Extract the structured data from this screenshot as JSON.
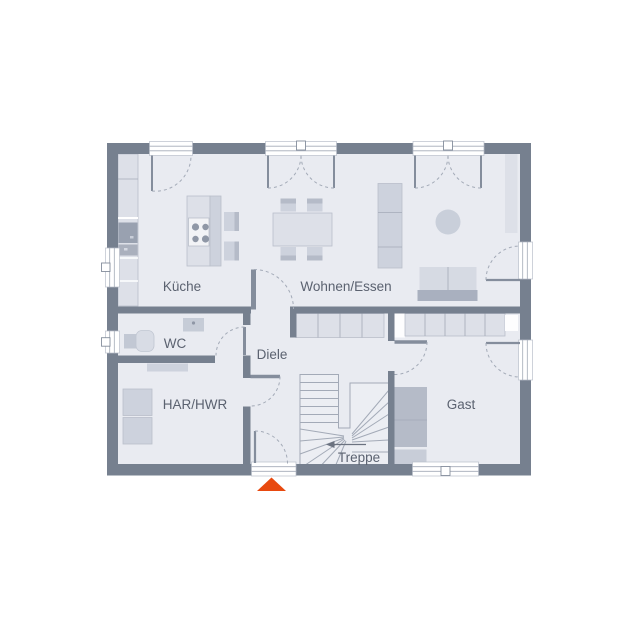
{
  "plan": {
    "rooms": {
      "kueche": "Küche",
      "wohnen_essen": "Wohnen/Essen",
      "wc": "WC",
      "diele": "Diele",
      "har_hwr": "HAR/HWR",
      "gast": "Gast",
      "treppe": "Treppe"
    }
  },
  "colors": {
    "wall": "#76808f",
    "floor": "#e9ebf1",
    "furn_light": "#dde0e8",
    "furn_mid": "#cdd2dd",
    "furn_dark": "#b5bbc8",
    "furn_edge": "#b9bfca",
    "appliance": "#99a1b0",
    "stroke": "#a3aab7",
    "leaf": "#848d9c",
    "label": "#5b6270",
    "burner": "#8f97a6",
    "entrance_arrow": "#e8490f"
  }
}
